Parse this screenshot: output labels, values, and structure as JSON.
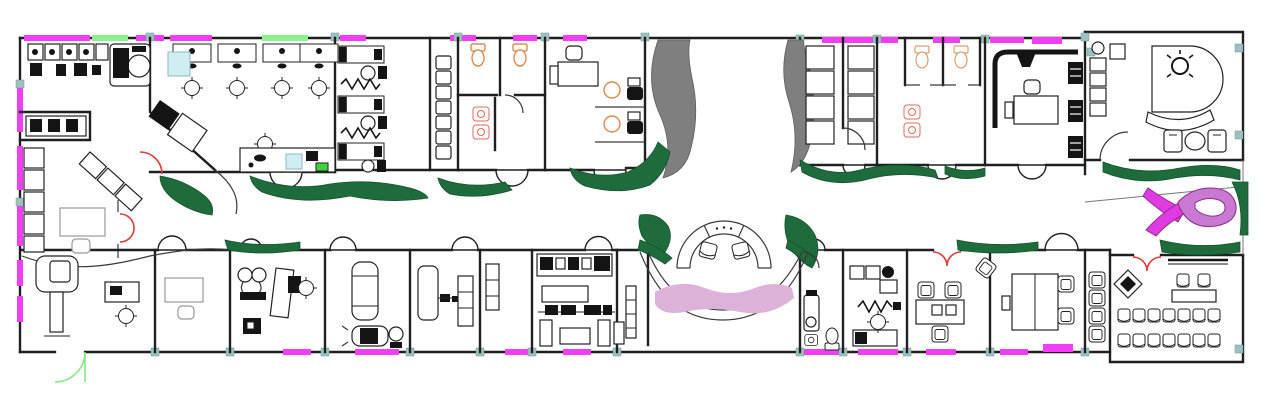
{
  "canvas": {
    "width": 1273,
    "height": 406
  },
  "title": "clinic-floor-plan",
  "colors": {
    "background": "#ffffff",
    "wall": "#1f1f1f",
    "window": "#f23ef2",
    "window_alt": "#8ff08f",
    "joint": "#9ec0c0",
    "plant": "#1e6b3c",
    "plant_edge": "#14532d",
    "tree": "#7f7f7f",
    "floor_accent": "#dcb2da",
    "ribbon": "#e23ae2",
    "ribbon_light": "#c979d2",
    "door_swing_red": "#e03a3a",
    "door_swing_green": "#86e686",
    "fixture_orange": "#dd8a4e",
    "sink_cyan": "#cfeef2",
    "accent_green_item": "#3ed43e",
    "furniture_stroke": "#222222",
    "furniture_gray": "#999999"
  },
  "elements": {
    "lab_bench": "lab-equipment-bench",
    "workstations": "staff-workstations-x4",
    "beds": "treatment-beds-x3",
    "toilets": "toilet-fixtures-orange",
    "reception": "semicircular-reception-desk",
    "ribbon": "awareness-ribbon-logo",
    "mammography": "mammography-machine",
    "conference": "conference-room-chair-rows",
    "executive": "executive-office-suite",
    "planting": "corridor-planting-green",
    "trees": "courtyard-tree-canopies"
  }
}
